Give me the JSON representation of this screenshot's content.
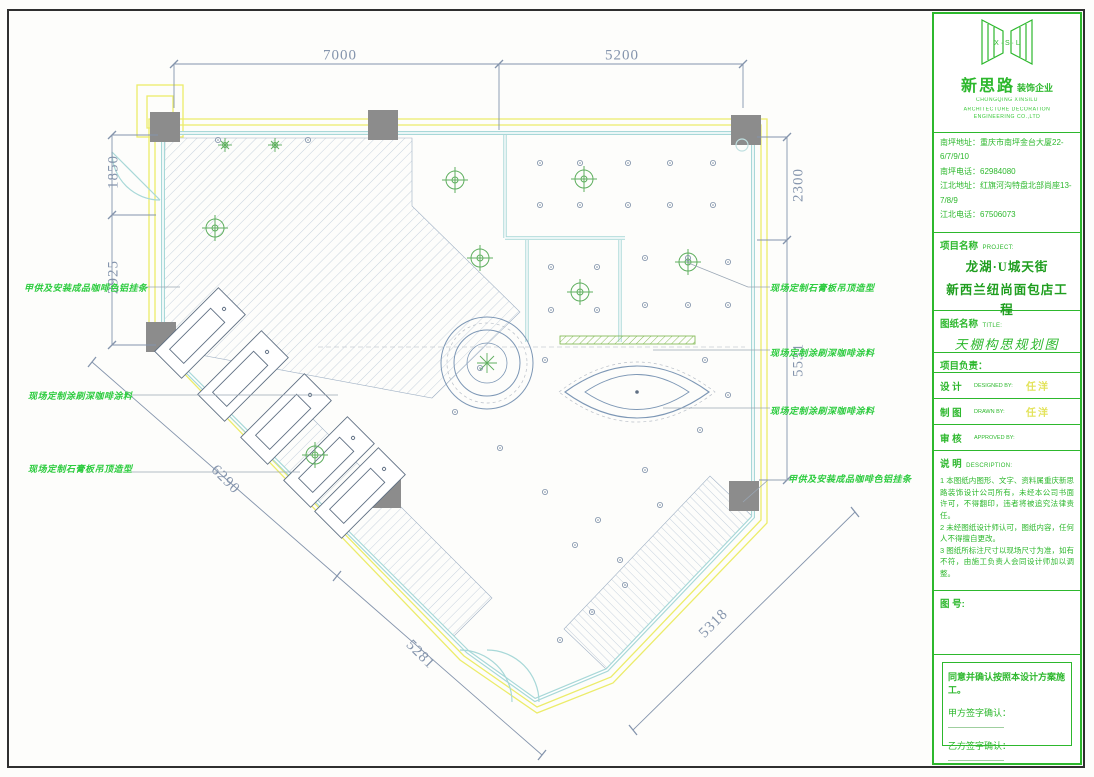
{
  "company": {
    "initials": "X · S · L",
    "name_cn": "新思路",
    "name_suffix": "装饰企业",
    "name_en_1": "CHONGQING XINSILU",
    "name_en_2": "ARCHITECTURE DECORATION ENGINEERING CO.,LTD",
    "contact_lines": [
      "南坪地址：重庆市南坪金台大厦22-6/7/9/10",
      "南坪电话：62984080",
      "江北地址：红旗河沟特盘北部尚座13-7/8/9",
      "江北电话：67506073"
    ]
  },
  "project": {
    "label_cn": "项目名称",
    "label_en": "PROJECT:",
    "line1": "龙湖·U城天街",
    "line2": "新西兰纽尚面包店工程"
  },
  "sheet": {
    "label_cn": "图纸名称",
    "label_en": "TITLE:",
    "title": "天棚构思规划图"
  },
  "team": {
    "leader_label": "项目负责：",
    "rows": [
      {
        "cn": "设  计",
        "en": "DESIGNED BY:",
        "value": "任洋"
      },
      {
        "cn": "制  图",
        "en": "DRAWN BY:",
        "value": "任洋"
      },
      {
        "cn": "审  核",
        "en": "APPROVED BY:",
        "value": ""
      }
    ]
  },
  "notes": {
    "label_cn": "说  明",
    "label_en": "DESCRIPTION:",
    "items": [
      "1  本图纸内图形、文字、资料属重庆新思路装饰设计公司所有，未经本公司书面许可，不得翻印，违者将被追究法律责任。",
      "2  未经图纸设计师认可，图纸内容，任何人不得擅自更改。",
      "3  图纸所标注尺寸以现场尺寸为准，如有不符，由施工负责人会同设计师加以调整。"
    ]
  },
  "fig_no_label": "图  号:",
  "sign": {
    "statement": "同意并确认按照本设计方案施工。",
    "party_a": "甲方签字确认：",
    "party_b": "乙方签字确认："
  },
  "dimensions": {
    "top": [
      "7000",
      "5200"
    ],
    "left": [
      "1850",
      "2925"
    ],
    "right": [
      "2300",
      "5531"
    ],
    "diagonal": [
      "6290",
      "5281",
      "5318"
    ]
  },
  "annotations": {
    "left": [
      "甲供及安装成品咖啡色铝挂条",
      "现场定制涂刷深咖啡涂料",
      "现场定制石膏板吊顶造型"
    ],
    "right": [
      "现场定制石膏板吊顶造型",
      "现场定制涂刷深咖啡涂料",
      "现场定制涂刷深咖啡涂料",
      "甲供及安装成品咖啡色铝挂条"
    ]
  },
  "colors": {
    "green": "#2db82d",
    "dark_green": "#1f9e1f",
    "annotation_green": "#2ecc40",
    "name_yellow": "#e3e35a",
    "dim_text": "#8494ac",
    "wall_cyan": "#a8d8d8",
    "boundary_yellow": "#ecec6a",
    "column_gray": "#8c8c8c",
    "hatch_blue": "#b9c6d6"
  }
}
